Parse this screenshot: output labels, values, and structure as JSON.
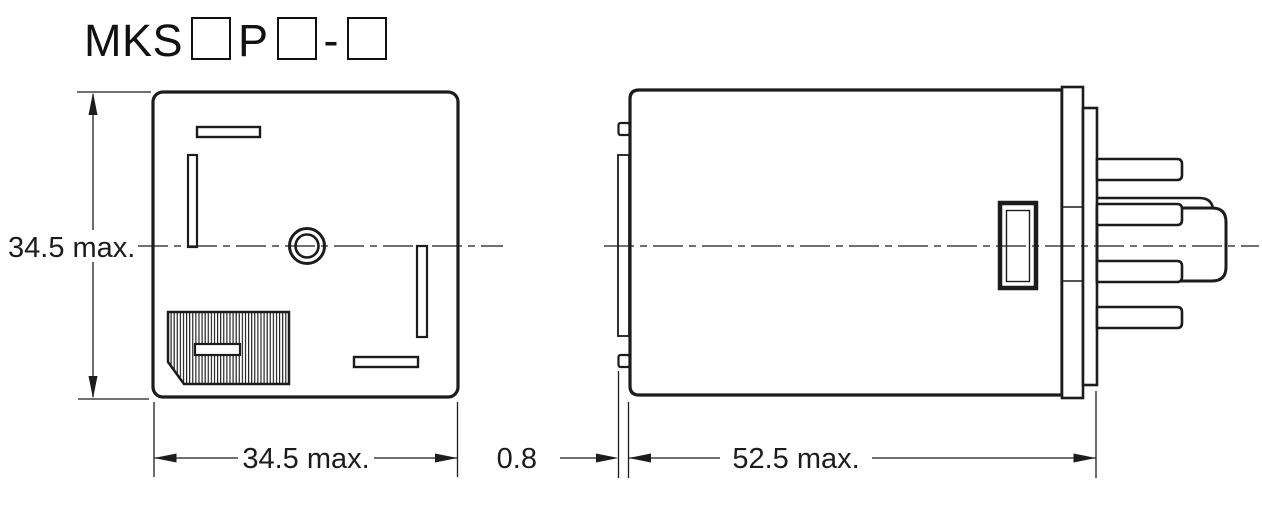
{
  "title": {
    "prefix": "MKS",
    "infix": "P",
    "separator": "-",
    "placeholder_box_count": 3
  },
  "front_view": {
    "height_label": "34.5 max.",
    "width_label": "34.5 max."
  },
  "side_view": {
    "offset_label": "0.8",
    "length_label": "52.5 max."
  },
  "colors": {
    "line": "#1c1c1c",
    "background": "#ffffff"
  }
}
